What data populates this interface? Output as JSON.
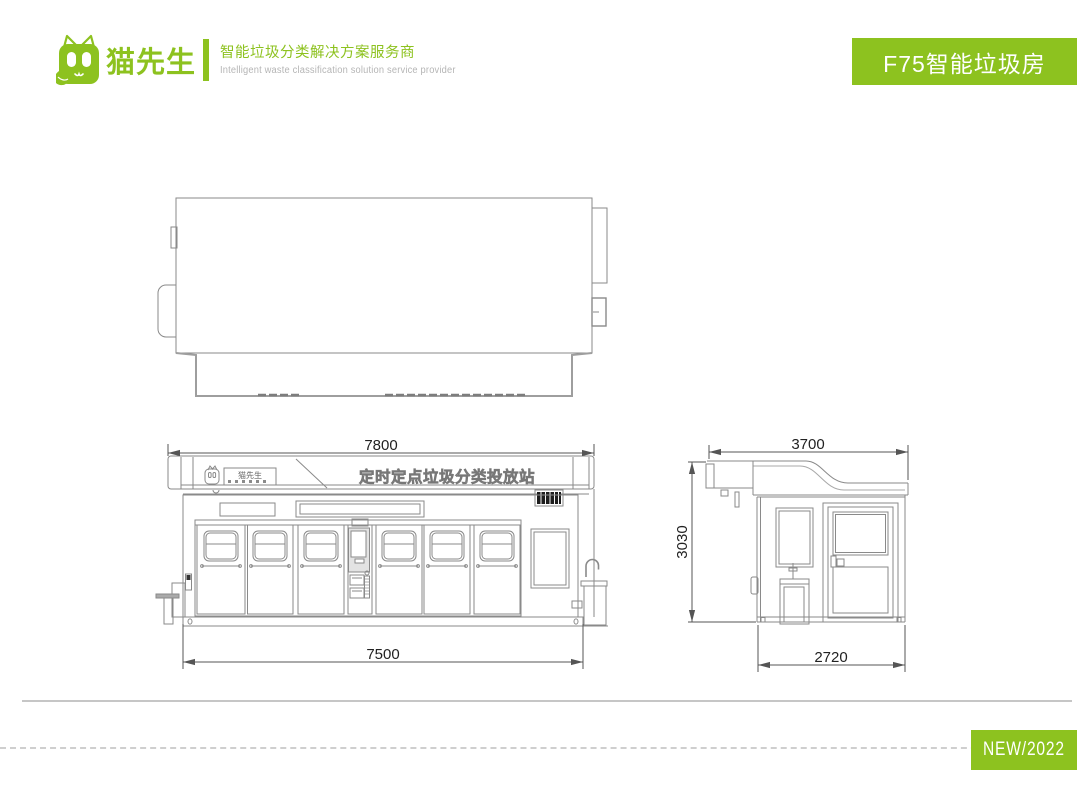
{
  "brand": {
    "logo_text": "猫先生",
    "tagline_zh": "智能垃圾分类解决方案服务商",
    "tagline_en": "Intelligent waste classification solution service provider"
  },
  "header_badge": {
    "label": "F75智能垃圾房"
  },
  "footer_badge": {
    "label": "NEW/2022"
  },
  "drawing": {
    "fascia_logo_text": "猫先生",
    "fascia_banner": "定时定点垃圾分类投放站",
    "dims": {
      "front_top_width": "7800",
      "front_bottom_width": "7500",
      "side_top_width": "3700",
      "side_height": "3030",
      "side_bottom_width": "2720"
    }
  },
  "colors": {
    "brand_green": "#8dc21f",
    "line_gray": "#8a8a8a"
  }
}
